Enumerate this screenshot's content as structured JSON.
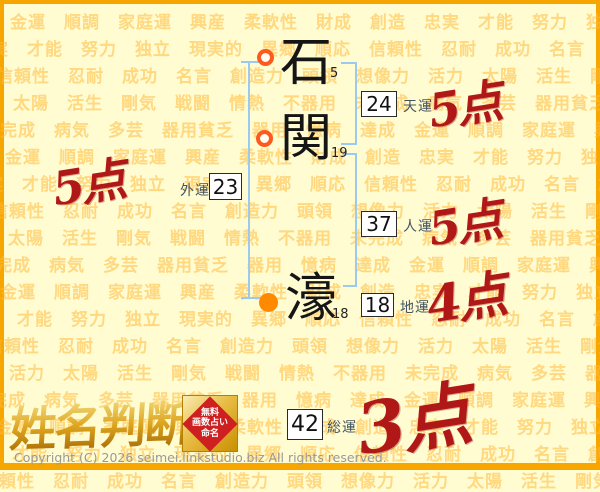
{
  "page": {
    "copyright": "Copyright (C) 2026 seimei.linkstudio.biz All rights reserved."
  },
  "colors": {
    "background": "#FFFCD2",
    "page_border": "#F7A600",
    "watermark_text": "rgba(255,185,60,0.55)",
    "bracket_blue": "#9CC9F0",
    "score_red": "#B01818",
    "marker_ring_orange": "#FF5A1E",
    "marker_fill_orange": "#FF8A00",
    "logo_gold": "#C8860B"
  },
  "background_words": [
    "金運",
    "順調",
    "家庭運",
    "興産",
    "柔軟性",
    "財成",
    "創造",
    "忠実",
    "才能",
    "努力",
    "独立",
    "現実的",
    "異郷",
    "順応",
    "信頼性",
    "忍耐",
    "成功",
    "名言",
    "創造力",
    "頭領",
    "想像力",
    "活力",
    "太陽",
    "活生",
    "剛気",
    "戦闘",
    "情熱",
    "不器用",
    "未完成",
    "病気",
    "多芸",
    "器用貧乏",
    "器用",
    "憶病",
    "達成"
  ],
  "name_chart": {
    "characters": [
      {
        "char": "石",
        "strokes": "5",
        "marker": "open-circle"
      },
      {
        "char": "関",
        "strokes": "19",
        "marker": "open-circle"
      },
      {
        "char": "濠",
        "strokes": "18",
        "marker": "filled-circle"
      }
    ],
    "fortunes": [
      {
        "key": "tenun",
        "label": "天運",
        "value": "24",
        "score": "5点"
      },
      {
        "key": "jinun",
        "label": "人運",
        "value": "37",
        "score": "5点"
      },
      {
        "key": "chiun",
        "label": "地運",
        "value": "18",
        "score": "4点"
      },
      {
        "key": "gaiun",
        "label": "外運",
        "value": "23",
        "score": "5点"
      },
      {
        "key": "souun",
        "label": "総運",
        "value": "42",
        "score": "3点"
      }
    ]
  },
  "logo": {
    "title": "姓名判断",
    "badge_lines": [
      "無料",
      "画数占い",
      "命名"
    ]
  }
}
